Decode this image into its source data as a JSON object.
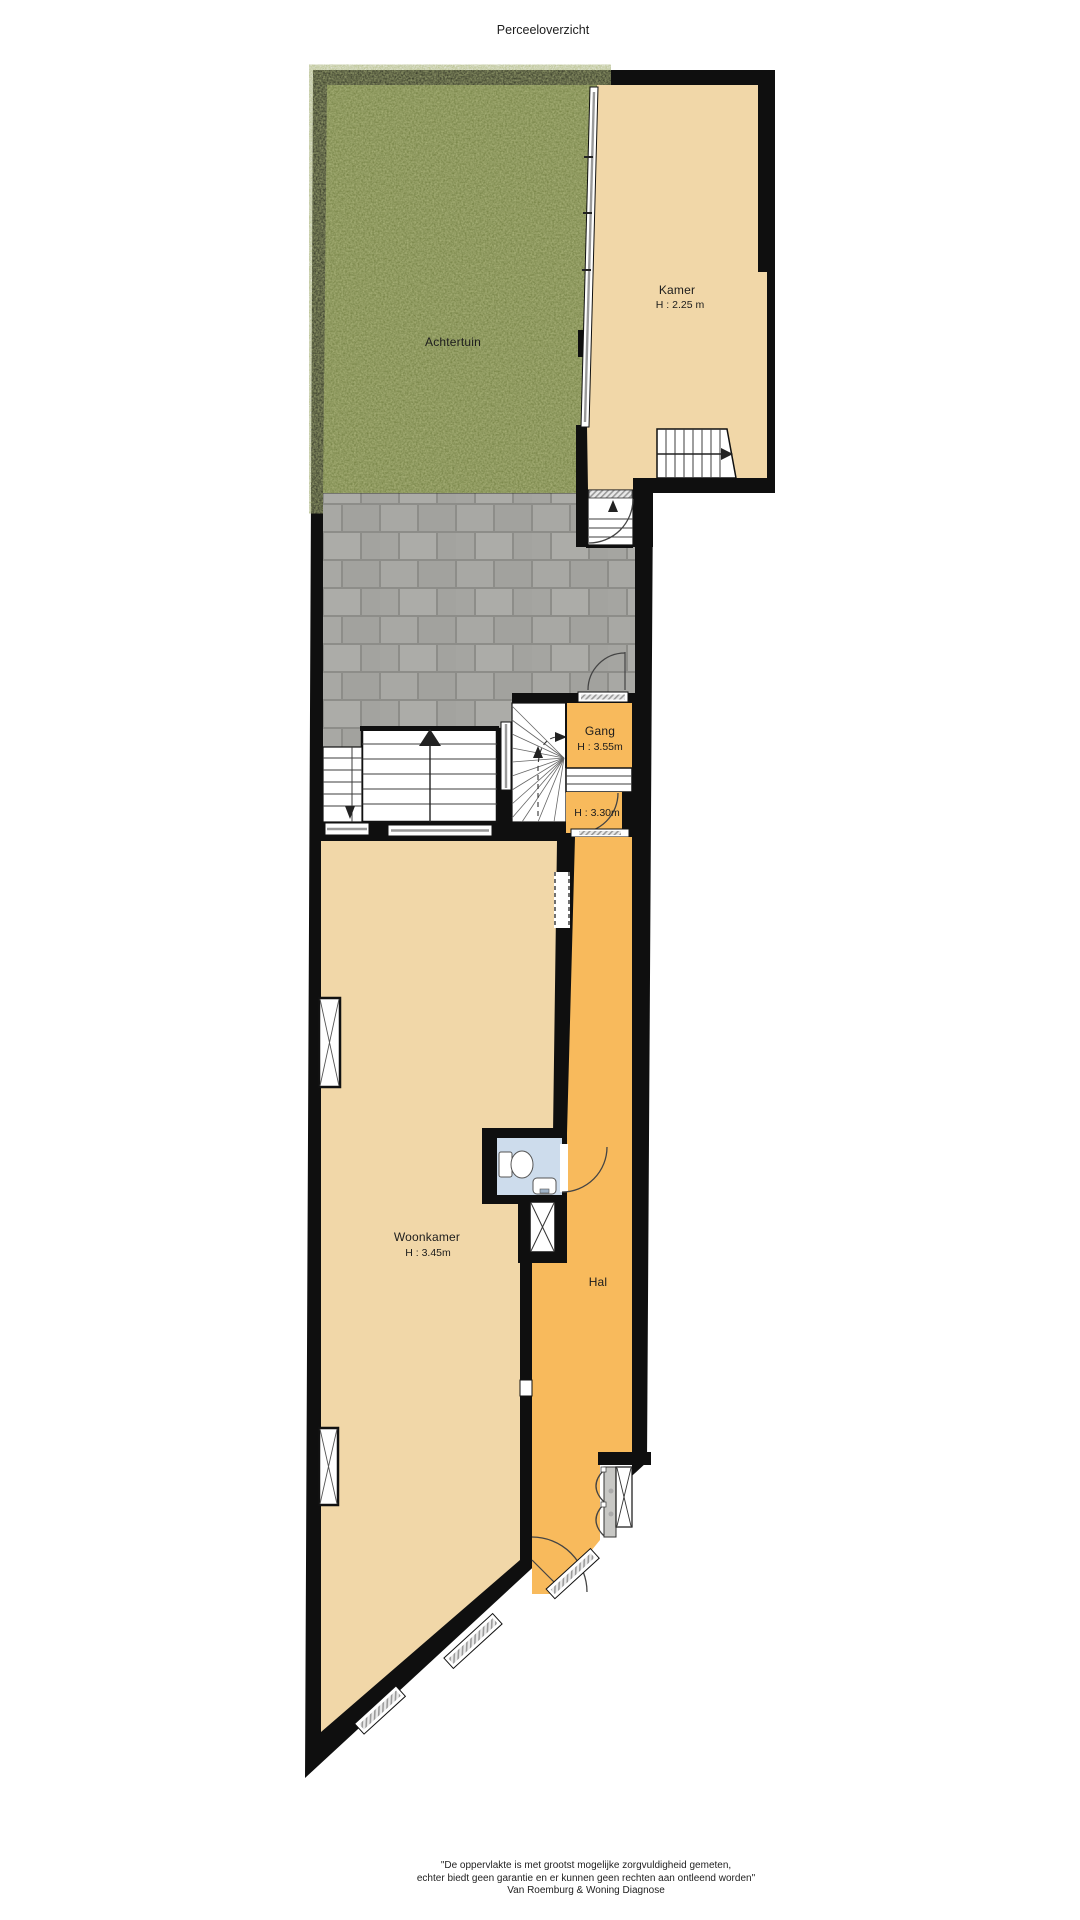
{
  "page": {
    "title": "Perceeloverzicht"
  },
  "rooms": {
    "achtertuin": {
      "label": "Achtertuin"
    },
    "kamer": {
      "label": "Kamer",
      "height": "H : 2.25 m"
    },
    "gang": {
      "label": "Gang",
      "height": "H : 3.55m"
    },
    "tussenniveau": {
      "height": "H : 3.30m"
    },
    "woonkamer": {
      "label": "Woonkamer",
      "height": "H : 3.45m"
    },
    "hal": {
      "label": "Hal"
    }
  },
  "footer": {
    "line1": "\"De oppervlakte is met grootst mogelijke zorgvuldigheid gemeten,",
    "line2": "echter biedt geen garantie en er kunnen geen rechten aan ontleend worden\"",
    "line3": "Van Roemburg & Woning Diagnose"
  },
  "colors": {
    "page_bg": "#ffffff",
    "wall": "#0f0f0f",
    "room_beige": "#f1d7a8",
    "room_orange": "#f8ba5c",
    "toilet_blue": "#cddcec",
    "grass_green": "#67742f",
    "paving_gray": "#a8a8a4",
    "paving_joint": "#8d8d89"
  }
}
